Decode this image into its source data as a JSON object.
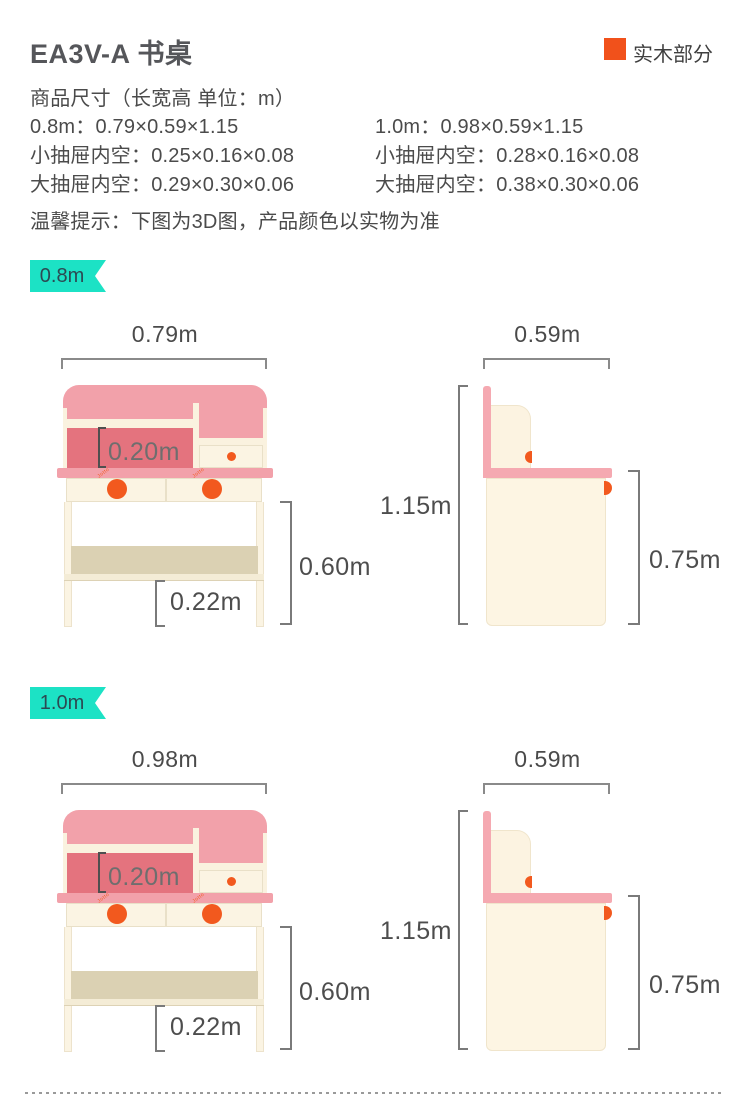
{
  "header": {
    "title": "EA3V-A 书桌",
    "legend_label": "实木部分"
  },
  "specs": {
    "heading": "商品尺寸（长宽高 单位：m）",
    "col_left": {
      "size": "0.8m：0.79×0.59×1.15",
      "small_drawer": "小抽屉内空：0.25×0.16×0.08",
      "big_drawer": "大抽屉内空：0.29×0.30×0.06"
    },
    "col_right": {
      "size": "1.0m：0.98×0.59×1.15",
      "small_drawer": "小抽屉内空：0.28×0.16×0.08",
      "big_drawer": "大抽屉内空：0.38×0.30×0.06"
    },
    "note": "温馨提示：下图为3D图，产品颜色以实物为准"
  },
  "sections": [
    {
      "badge": "0.8m",
      "front": {
        "width": "0.79m",
        "inner_height": "0.20m",
        "under_height": "0.60m",
        "shelf_clearance": "0.22m"
      },
      "side": {
        "depth": "0.59m",
        "total_height": "1.15m",
        "desk_height": "0.75m"
      },
      "knob_mark": "Jotto"
    },
    {
      "badge": "1.0m",
      "front": {
        "width": "0.98m",
        "inner_height": "0.20m",
        "under_height": "0.60m",
        "shelf_clearance": "0.22m"
      },
      "side": {
        "depth": "0.59m",
        "total_height": "1.15m",
        "desk_height": "0.75m"
      },
      "knob_mark": "Jotto"
    }
  ],
  "colors": {
    "accent_orange": "#f1511b",
    "knob_orange": "#f2591e",
    "badge_teal": "#1ce2c5",
    "pink_light": "#f2a1aa",
    "pink_dark": "#e4737e",
    "cream": "#fbf4e3",
    "tan": "#dbd1b3",
    "text_dark": "#4b4b4b"
  }
}
